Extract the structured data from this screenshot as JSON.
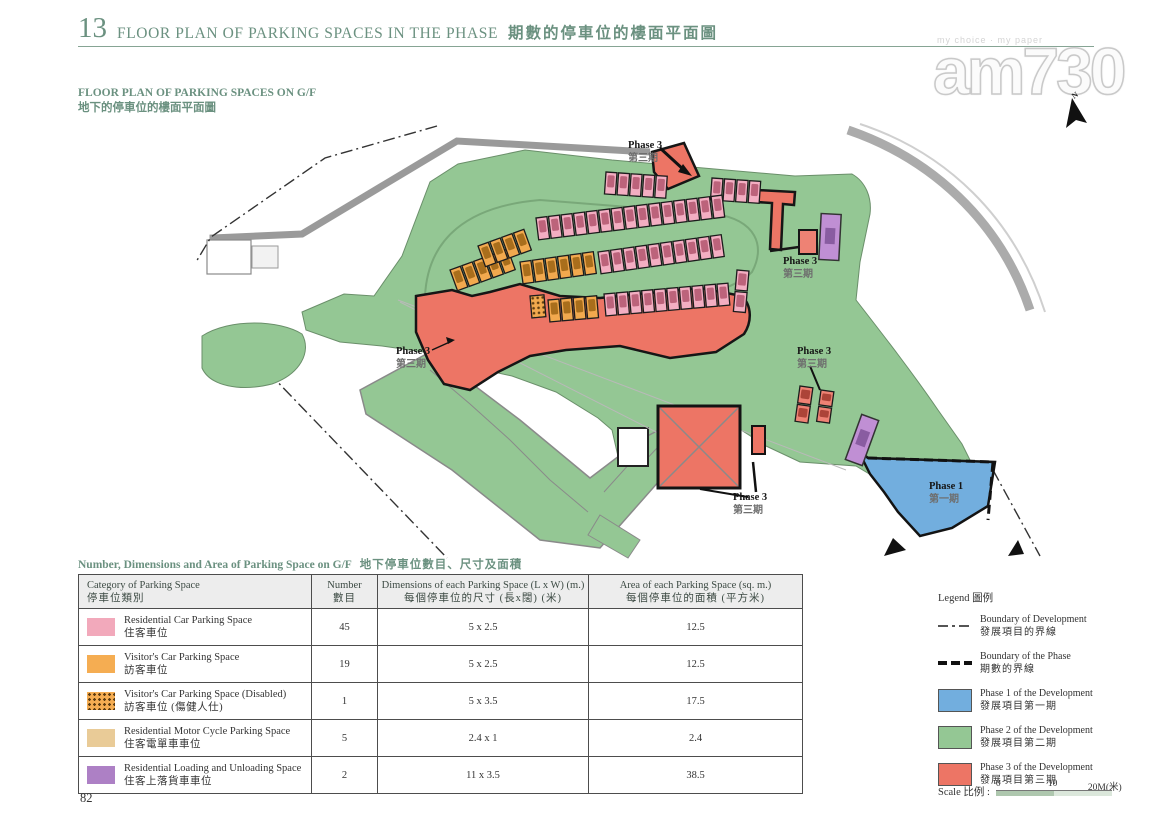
{
  "page": {
    "number": "82"
  },
  "header": {
    "section_no": "13",
    "title_en": "FLOOR PLAN OF PARKING SPACES IN THE PHASE",
    "title_zh": "期數的停車位的樓面平面圖",
    "accent_color": "#6b9180"
  },
  "watermark": {
    "tagline": "my choice · my paper",
    "brand": "am730"
  },
  "subtitle": {
    "en": "FLOOR PLAN OF PARKING SPACES ON G/F",
    "zh": "地下的停車位的樓面平面圖"
  },
  "map": {
    "north_label": "N",
    "colors": {
      "phase1": "#72aede",
      "phase2": "#94c794",
      "phase3": "#ed7565",
      "pink": "#f3aec2",
      "pink_car": "#b2566f",
      "orange": "#f2a94e",
      "orange_car": "#9c6414",
      "red": "#ee8274",
      "red_car": "#a03a2e",
      "checker_dot": "#5e3c10",
      "purple": "#c08fd4"
    },
    "labels": [
      {
        "en": "Phase 3",
        "zh": "第三期",
        "x": 628,
        "y": 148
      },
      {
        "en": "Phase 3",
        "zh": "第三期",
        "x": 783,
        "y": 264
      },
      {
        "en": "Phase 3",
        "zh": "第三期",
        "x": 396,
        "y": 354
      },
      {
        "en": "Phase 3",
        "zh": "第三期",
        "x": 797,
        "y": 354
      },
      {
        "en": "Phase 3",
        "zh": "第三期",
        "x": 733,
        "y": 500
      },
      {
        "en": "Phase 1",
        "zh": "第一期",
        "x": 929,
        "y": 489
      }
    ],
    "parking_rows": [
      {
        "x": 606,
        "y": 172,
        "angle": 4,
        "count": 5,
        "color": "pink"
      },
      {
        "x": 712,
        "y": 178,
        "angle": 4,
        "count": 4,
        "color": "pink"
      },
      {
        "x": 536,
        "y": 218,
        "angle": -7,
        "count": 15,
        "color": "pink"
      },
      {
        "x": 598,
        "y": 252,
        "angle": -8,
        "count": 10,
        "color": "pink"
      },
      {
        "x": 520,
        "y": 262,
        "angle": -8,
        "count": 6,
        "color": "orange"
      },
      {
        "x": 450,
        "y": 270,
        "angle": -20,
        "count": 5,
        "color": "orange"
      },
      {
        "x": 478,
        "y": 246,
        "angle": -20,
        "count": 4,
        "color": "orange"
      },
      {
        "x": 530,
        "y": 296,
        "angle": -5,
        "count": 1,
        "color": "checker",
        "w": 14
      },
      {
        "x": 548,
        "y": 300,
        "angle": -5,
        "count": 4,
        "color": "orange"
      },
      {
        "x": 604,
        "y": 294,
        "angle": -5,
        "count": 10,
        "color": "pink"
      },
      {
        "x": 737,
        "y": 270,
        "angle": 5,
        "count": 2,
        "color": "pink",
        "w": 12,
        "h": 20,
        "vertical": true
      },
      {
        "x": 800,
        "y": 386,
        "angle": 8,
        "count": 2,
        "color": "red",
        "w": 13,
        "h": 17,
        "vertical": true
      },
      {
        "x": 821,
        "y": 390,
        "angle": 8,
        "count": 2,
        "color": "red",
        "w": 13,
        "h": 15,
        "vertical": true
      }
    ]
  },
  "table": {
    "title_en": "Number, Dimensions and Area of Parking Space on G/F",
    "title_zh": "地下停車位數目、尺寸及面積",
    "headers": [
      {
        "en": "Category of Parking Space",
        "zh": "停車位類別"
      },
      {
        "en": "Number",
        "zh": "數目"
      },
      {
        "en": "Dimensions of each Parking Space (L x W) (m.)",
        "zh": "每個停車位的尺寸 (長x闊) (米)"
      },
      {
        "en": "Area of each Parking Space (sq. m.)",
        "zh": "每個停車位的面積 (平方米)"
      }
    ],
    "rows": [
      {
        "swatch": "plain",
        "swatch_color": "#f2a9bb",
        "en": "Residential Car Parking Space",
        "zh": "住客車位",
        "number": "45",
        "dims": "5 x 2.5",
        "area": "12.5"
      },
      {
        "swatch": "plain",
        "swatch_color": "#f5ad52",
        "en": "Visitor's Car Parking Space",
        "zh": "訪客車位",
        "number": "19",
        "dims": "5 x 2.5",
        "area": "12.5"
      },
      {
        "swatch": "checker",
        "swatch_color": "#f5ad52",
        "en": "Visitor's Car Parking Space (Disabled)",
        "zh": "訪客車位 (傷健人仕)",
        "number": "1",
        "dims": "5 x 3.5",
        "area": "17.5"
      },
      {
        "swatch": "plain",
        "swatch_color": "#e9cb97",
        "en": "Residential Motor Cycle Parking Space",
        "zh": "住客電單車車位",
        "number": "5",
        "dims": "2.4 x 1",
        "area": "2.4"
      },
      {
        "swatch": "plain",
        "swatch_color": "#ad80c5",
        "en": "Residential Loading and Unloading Space",
        "zh": "住客上落貨車車位",
        "number": "2",
        "dims": "11 x 3.5",
        "area": "38.5"
      }
    ]
  },
  "legend": {
    "title_en": "Legend",
    "title_zh": "圖例",
    "items": [
      {
        "type": "dashdot",
        "color": "#555555",
        "en": "Boundary of Development",
        "zh": "發展項目的界線"
      },
      {
        "type": "dash",
        "color": "#111111",
        "en": "Boundary of the Phase",
        "zh": "期數的界線"
      },
      {
        "type": "swatch",
        "color": "#72aede",
        "en": "Phase 1 of the Development",
        "zh": "發展項目第一期"
      },
      {
        "type": "swatch",
        "color": "#94c794",
        "en": "Phase 2 of the Development",
        "zh": "發展項目第二期"
      },
      {
        "type": "swatch",
        "color": "#ed7565",
        "en": "Phase 3 of the Development",
        "zh": "發展項目第三期"
      }
    ]
  },
  "scale": {
    "label_en": "Scale",
    "label_zh": "比例",
    "ticks": [
      "0",
      "10",
      "20M(米)"
    ]
  }
}
